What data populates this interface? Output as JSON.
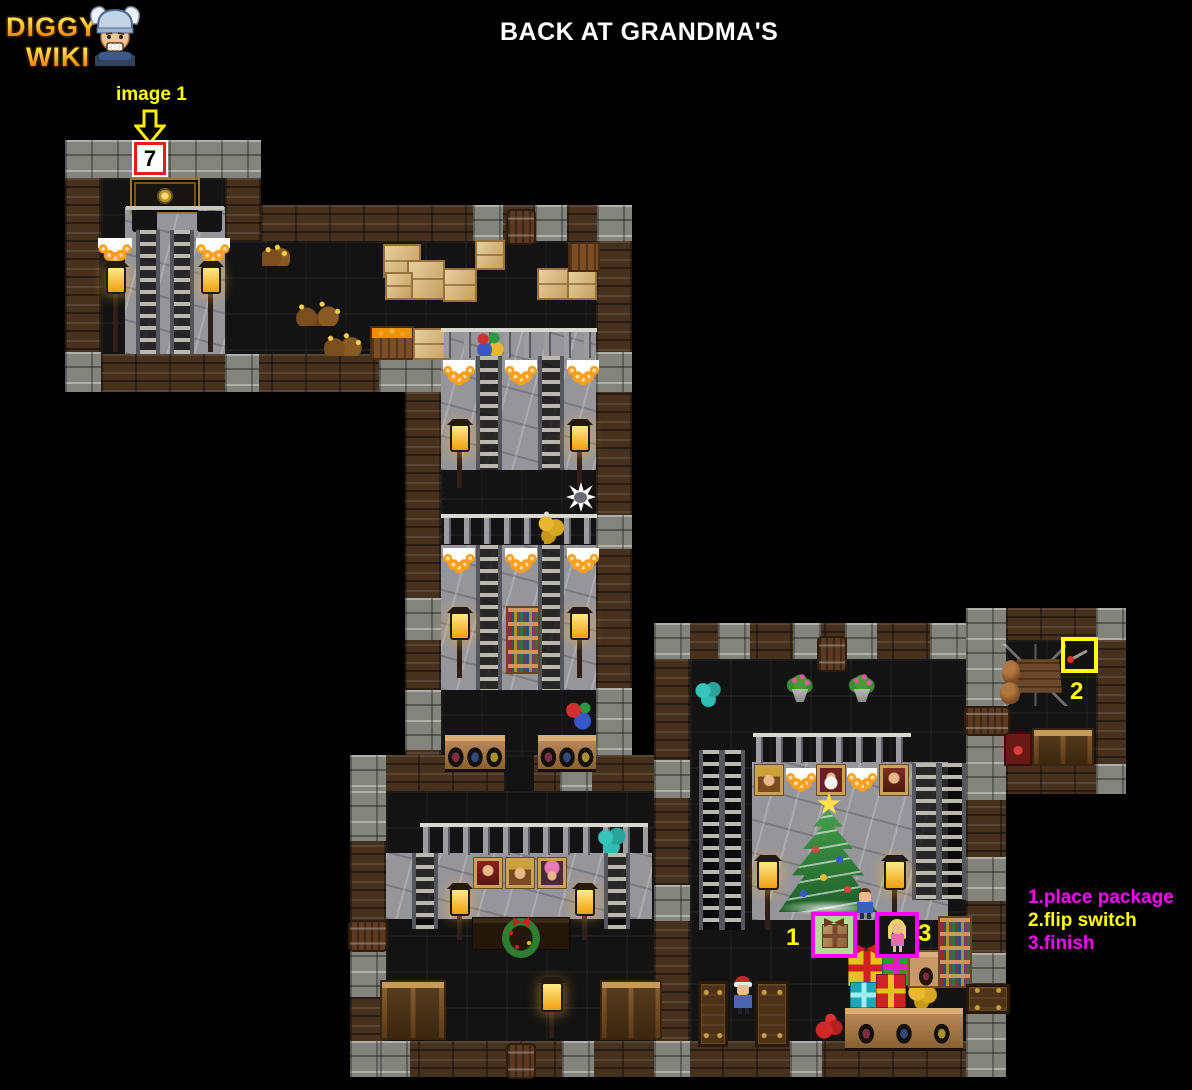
{
  "header": {
    "logo_line1": "DIGGY'S",
    "logo_line2": "WIKI",
    "mascot_icon": "diggy-mascot-icon",
    "title": "BACK AT GRANDMA'S"
  },
  "annotations": {
    "image_label": "image 1",
    "arrow_icon": "block-arrow-down-icon",
    "exit_marker_value": "7",
    "step1": "1",
    "step2": "2",
    "step3": "3",
    "highlight_icons": [
      "package-highlight-box",
      "switch-highlight-box",
      "finish-highlight-box"
    ]
  },
  "legend": {
    "items": [
      {
        "text": "1.place package",
        "color": "#ff00ff"
      },
      {
        "text": "2.flip switch",
        "color": "#ffff00"
      },
      {
        "text": "3.finish",
        "color": "#ff00ff"
      }
    ]
  },
  "colors": {
    "background": "#000000",
    "annotation_yellow": "#ffff00",
    "annotation_magenta": "#ff00ff",
    "marker_border_red": "#e02010",
    "wood_wall": "#46301e",
    "stone_wall": "#84847f",
    "stone_interior": "#95959a"
  },
  "map_key_objects": [
    "exit-door-icon",
    "ladder-icon",
    "garland-icon",
    "lantern-icon",
    "gift-package-icon",
    "girl-character-icon",
    "boy-character-icon",
    "grandma-character-icon",
    "switch-lever-icon",
    "mine-cart-icon",
    "christmas-tree-icon",
    "wreath-icon",
    "portrait-icon",
    "bookshelf-icon",
    "cabinet-icon",
    "barrel-icon",
    "ornament-balls-icon",
    "flower-pot-icon",
    "cardboard-box-icon",
    "gold-ore-icon",
    "rat-icon",
    "balustrade-icon",
    "presents-icon"
  ]
}
